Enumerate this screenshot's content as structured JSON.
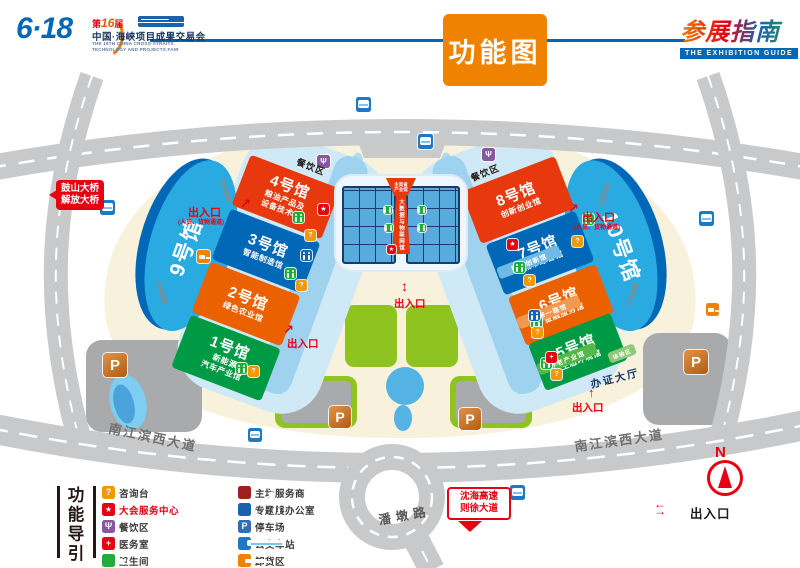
{
  "header": {
    "title": "功能图",
    "logo": {
      "mark": "6·18",
      "edition_pre": "第",
      "edition_num": "16",
      "edition_post": "届",
      "cn_name": "中国·海峡项目成果交易会",
      "en_line1": "THE 16TH CHINA CROSS-STRAITS",
      "en_line2": "TECHNOLOGY AND PROJECTS FAIR"
    },
    "guide": {
      "cn": "参展指南",
      "en": "THE EXHIBITION GUIDE"
    }
  },
  "map": {
    "halls": [
      {
        "name": "1号馆",
        "sub": "新能源\n汽车产业馆",
        "color": "#009944"
      },
      {
        "name": "2号馆",
        "sub": "绿色农业馆",
        "color": "#eb6100"
      },
      {
        "name": "3号馆",
        "sub": "智能制造馆",
        "color": "#0068b7"
      },
      {
        "name": "4号馆",
        "sub": "粮油产品及\n设备技术馆",
        "color": "#e8380d"
      },
      {
        "name": "5号馆",
        "sub": "生态环境馆",
        "color": "#009944"
      },
      {
        "name": "6号馆",
        "sub": "金融服务馆",
        "color": "#eb6100"
      },
      {
        "name": "7号馆",
        "sub": "城市综合馆",
        "color": "#0068b7"
      },
      {
        "name": "8号馆",
        "sub": "创新创业馆",
        "color": "#e8380d"
      },
      {
        "name": "9号馆",
        "color": "#29abe2"
      },
      {
        "name": "10号馆",
        "color": "#29abe2"
      }
    ],
    "sub_halls": [
      {
        "name": "国企创新馆",
        "color": "#6fb9e6"
      },
      {
        "name": "一带一路馆",
        "color": "#f3994f"
      },
      {
        "name": "养老产业馆",
        "color": "#54b847"
      },
      {
        "name": "体验区",
        "color": "#8fc97a"
      }
    ],
    "center": {
      "top_hall": "主宾省\n产业馆",
      "strip_hall": "大数据与物联网馆"
    },
    "labels": {
      "dining": "餐饮区",
      "corridor": "风雨连廊",
      "cert_hall": "办证大厅",
      "pandun_road": "潘墩路",
      "avenue": "南江滨西大道",
      "entrance": "出入口",
      "entrance_sub": "(人员、货物通道)"
    },
    "signs": {
      "bridge1": "鼓山大桥",
      "bridge2": "解放大桥",
      "exp1": "沈海高速",
      "exp2": "则徐大道"
    },
    "compass": "N",
    "icons": [
      {
        "t": "bus",
        "x": 100,
        "y": 200,
        "s": 15
      },
      {
        "t": "bus",
        "x": 356,
        "y": 97,
        "s": 15
      },
      {
        "t": "bus",
        "x": 418,
        "y": 134,
        "s": 15
      },
      {
        "t": "bus",
        "x": 699,
        "y": 211,
        "s": 15
      },
      {
        "t": "bus",
        "x": 510,
        "y": 485,
        "s": 15
      },
      {
        "t": "bus",
        "x": 248,
        "y": 428,
        "s": 14
      },
      {
        "t": "parkmap",
        "x": 103,
        "y": 353,
        "s": 24
      },
      {
        "t": "parkmap",
        "x": 329,
        "y": 406,
        "s": 22
      },
      {
        "t": "parkmap",
        "x": 459,
        "y": 408,
        "s": 22
      },
      {
        "t": "parkmap",
        "x": 684,
        "y": 350,
        "s": 24
      },
      {
        "t": "toilet",
        "x": 293,
        "y": 212,
        "s": 11
      },
      {
        "t": "toilet",
        "x": 285,
        "y": 268,
        "s": 11
      },
      {
        "t": "toilet",
        "x": 236,
        "y": 363,
        "s": 11
      },
      {
        "t": "toilet",
        "x": 583,
        "y": 214,
        "s": 11
      },
      {
        "t": "toilet",
        "x": 514,
        "y": 262,
        "s": 11
      },
      {
        "t": "toilet",
        "x": 531,
        "y": 317,
        "s": 11
      },
      {
        "t": "toilet",
        "x": 541,
        "y": 358,
        "s": 11
      },
      {
        "t": "toilet",
        "x": 384,
        "y": 206,
        "s": 8
      },
      {
        "t": "toilet",
        "x": 418,
        "y": 206,
        "s": 8
      },
      {
        "t": "toilet",
        "x": 385,
        "y": 224,
        "s": 8
      },
      {
        "t": "toilet",
        "x": 418,
        "y": 224,
        "s": 8
      },
      {
        "t": "info",
        "x": 305,
        "y": 230,
        "s": 11
      },
      {
        "t": "info",
        "x": 296,
        "y": 280,
        "s": 11
      },
      {
        "t": "info",
        "x": 248,
        "y": 366,
        "s": 11
      },
      {
        "t": "info",
        "x": 572,
        "y": 236,
        "s": 11
      },
      {
        "t": "info",
        "x": 524,
        "y": 275,
        "s": 11
      },
      {
        "t": "info",
        "x": 532,
        "y": 327,
        "s": 11
      },
      {
        "t": "info",
        "x": 551,
        "y": 369,
        "s": 11
      },
      {
        "t": "service",
        "x": 318,
        "y": 204,
        "s": 11
      },
      {
        "t": "service",
        "x": 507,
        "y": 239,
        "s": 11
      },
      {
        "t": "service",
        "x": 387,
        "y": 245,
        "s": 9
      },
      {
        "t": "medical",
        "x": 546,
        "y": 352,
        "s": 11
      },
      {
        "t": "office",
        "x": 301,
        "y": 250,
        "s": 11
      },
      {
        "t": "office",
        "x": 529,
        "y": 310,
        "s": 11
      },
      {
        "t": "truck",
        "x": 197,
        "y": 250,
        "s": 13
      },
      {
        "t": "truck",
        "x": 706,
        "y": 303,
        "s": 13
      },
      {
        "t": "dining",
        "x": 317,
        "y": 155,
        "s": 13
      },
      {
        "t": "dining",
        "x": 482,
        "y": 148,
        "s": 13
      }
    ]
  },
  "icon_glyphs": {
    "info": "?",
    "parking": "P",
    "parkmap": "P",
    "medical": "+",
    "service": "★",
    "dining": "Ψ"
  },
  "legend": {
    "title": "功能导引",
    "col1": [
      {
        "icon": "info",
        "label": "咨询台"
      },
      {
        "icon": "service",
        "label": "大会服务中心"
      },
      {
        "icon": "dining",
        "label": "餐饮区"
      },
      {
        "icon": "medical",
        "label": "医务室"
      },
      {
        "icon": "toilet",
        "label": "卫生间"
      }
    ],
    "col2": [
      {
        "icon": "host",
        "label": "主场服务商"
      },
      {
        "icon": "office",
        "label": "专题展办公室"
      },
      {
        "icon": "parking",
        "label": "停车场"
      },
      {
        "icon": "bus",
        "label": "公交车站"
      },
      {
        "icon": "truck",
        "label": "卸货区"
      }
    ],
    "exit_label": "出入口"
  }
}
